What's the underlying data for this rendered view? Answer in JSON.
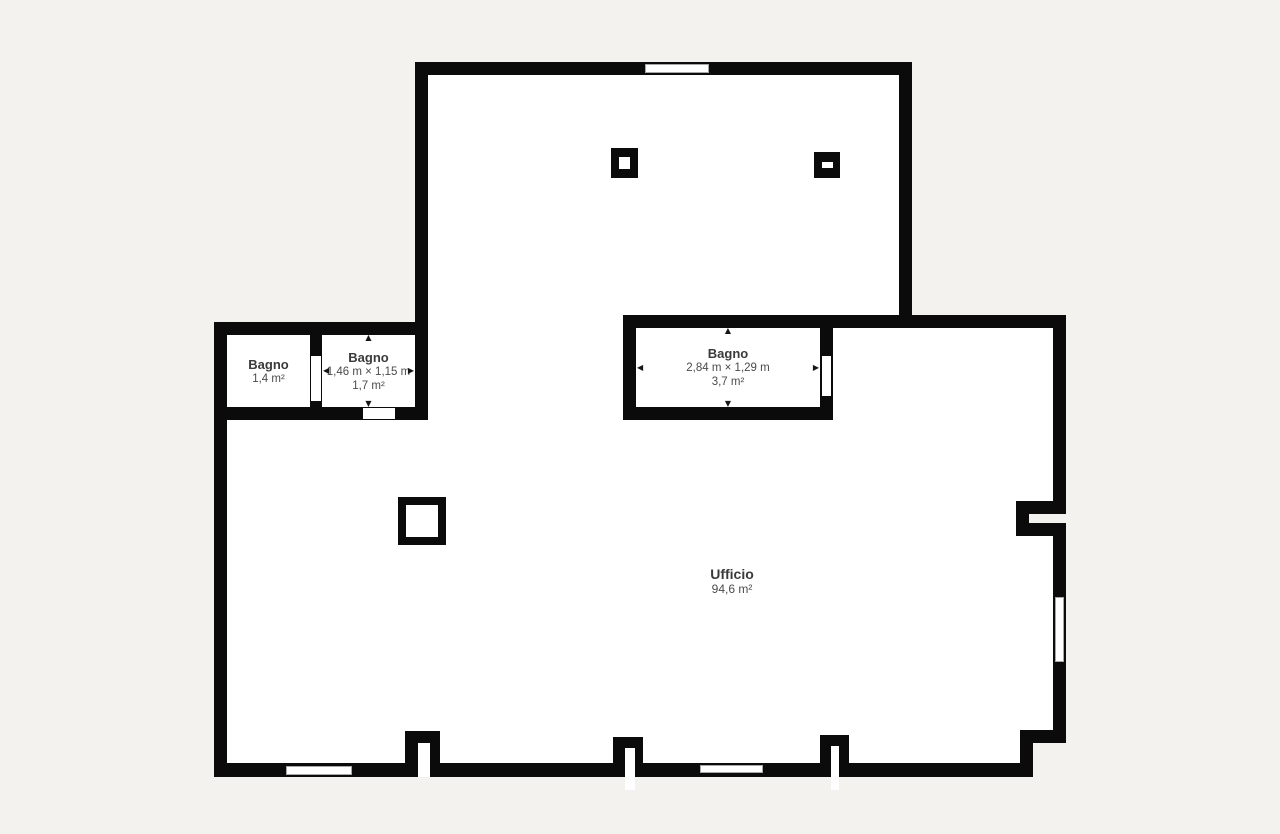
{
  "plan": {
    "background_color": "#f3f2ef",
    "wall_color": "#0b0b0b",
    "room_fill": "#ffffff",
    "text_color": "#3a3a3a",
    "secondary_text_color": "#4b4b4b"
  },
  "rooms": {
    "bagno_small": {
      "name": "Bagno",
      "area": "1,4 m²"
    },
    "bagno_medium": {
      "name": "Bagno",
      "dimensions": "1,46 m × 1,15 m",
      "area": "1,7 m²"
    },
    "bagno_large": {
      "name": "Bagno",
      "dimensions": "2,84 m × 1,29 m",
      "area": "3,7 m²"
    },
    "ufficio": {
      "name": "Ufficio",
      "area": "94,6 m²"
    }
  },
  "icons": {
    "arrow_up": "▲",
    "arrow_down": "▼",
    "arrow_left": "◀",
    "arrow_right": "▶"
  }
}
